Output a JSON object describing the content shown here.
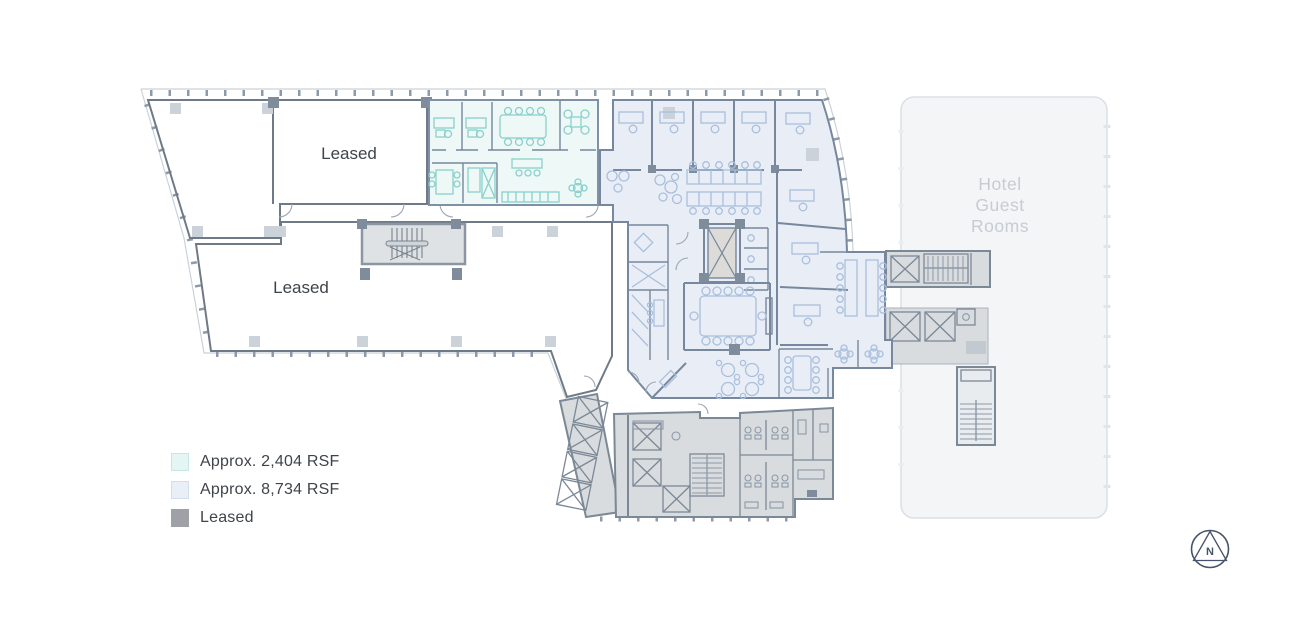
{
  "plan": {
    "type": "office-floor-plan",
    "leased_upper_label": "Leased",
    "leased_lower_label": "Leased",
    "hotel_label_line1": "Hotel",
    "hotel_label_line2": "Guest",
    "hotel_label_line3": "Rooms",
    "compass_label": "N",
    "regions": {
      "available_small": {
        "name": "Approx. 2,404 RSF suite",
        "fill": "#edf8f7",
        "furniture": "#8ad0cb"
      },
      "available_large": {
        "name": "Approx. 8,734 RSF suite",
        "fill": "#e9eef6",
        "furniture": "#a9bfdd"
      },
      "leased": {
        "name": "Leased space",
        "fill": "#a2a5aa"
      },
      "core": {
        "name": "Building core (elevators, stairs, restrooms)",
        "fill": "#d9dcdf"
      },
      "hotel": {
        "name": "Hotel guest rooms",
        "fill": "#f4f5f7"
      }
    }
  },
  "legend": {
    "items": [
      {
        "label": "Approx. 2,404 RSF",
        "swatch_color": "#e4f5f3",
        "swatch_border": "#c6e8e4"
      },
      {
        "label": "Approx. 8,734 RSF",
        "swatch_color": "#e9eff7",
        "swatch_border": "#d3ddec"
      },
      {
        "label": "Leased",
        "swatch_color": "#9ea2a7",
        "swatch_border": "#9ea2a7"
      }
    ]
  },
  "colors": {
    "leased_fill": "#a2a5aa",
    "leased_wall": "#6f7a87",
    "teal_fill": "#edf8f7",
    "teal_furniture": "#8ad0cb",
    "blue_fill": "#e9eef6",
    "blue_wall": "#76879e",
    "blue_furniture": "#a9bfdd",
    "core_fill": "#d9dcdf",
    "hotel_fill": "#f4f5f7",
    "hotel_text": "#c6ccd3",
    "label_text": "#3f444a",
    "compass": "#47536a"
  }
}
